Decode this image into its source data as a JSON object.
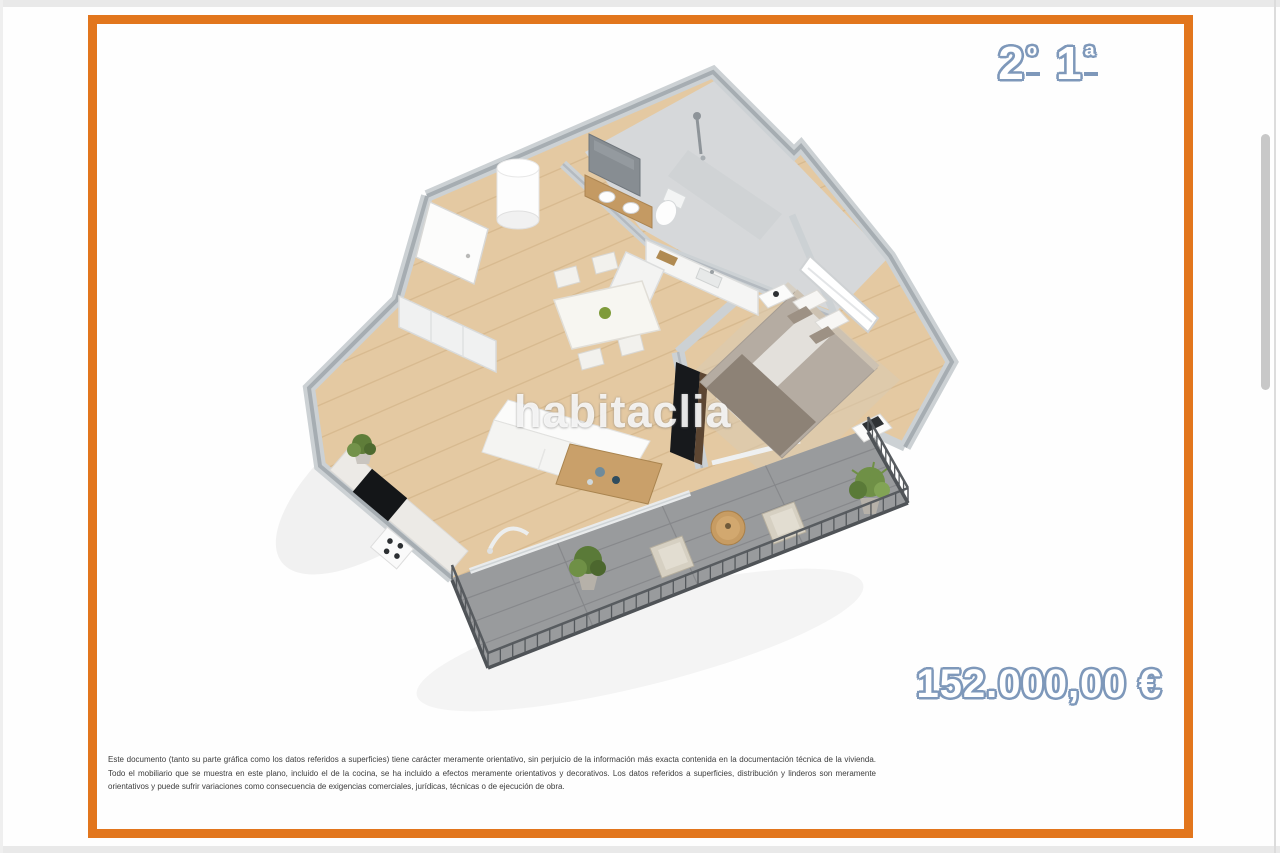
{
  "header": {
    "unit": {
      "floor_number": "2",
      "floor_ordinal": "º",
      "apartment_number": "1",
      "apartment_ordinal": "ª"
    }
  },
  "price_label": "152.000,00 €",
  "watermark_text": "habitaclia",
  "disclaimer": "Este documento (tanto su parte gráfica como los datos referidos a superficies) tiene carácter meramente orientativo, sin perjuicio de la información más exacta contenida en la documentación técnica de la vivienda. Todo el mobiliario que se muestra en este plano, incluido el de la cocina, se ha incluido a efectos meramente orientativos y decorativos. Los datos referidos a superficies, distribución y linderos son meramente orientativos y puede sufrir variaciones como consecuencia de exigencias comerciales, jurídicas, técnicas o de ejecución de obra.",
  "colors": {
    "frame_orange": "#e2761d",
    "label_outline_blue": "#7e98ba",
    "wall_gray": "#ccd1d4",
    "wall_top_gray": "#a6adb2",
    "wood_floor": "#e4c9a2",
    "wood_plank_line": "#d5b78c",
    "bathroom_floor": "#d6d8da",
    "terrace_tile": "#999b9d",
    "terrace_tile_line": "#85878a",
    "railing_dark_gray": "#4f5357",
    "watermark_white": "#ffffff"
  },
  "floor_plan": {
    "view": "isometric-3d-render",
    "elements": [
      "entrance-hall",
      "entry-door",
      "wardrobe",
      "water-heater",
      "bathroom",
      "wall-mirror",
      "vanity-sink",
      "toilet",
      "shower",
      "kitchen-counter",
      "kitchen-sink",
      "cooktop",
      "oven-knobs",
      "dining-table",
      "dining-chairs",
      "green-centerpiece",
      "living-room",
      "sofa",
      "coffee-table",
      "floor-lamp",
      "tv-panel",
      "bedroom",
      "double-bed",
      "pillows",
      "headboard",
      "nightstand-left",
      "nightstand-right",
      "bedroom-window",
      "bedroom-rug",
      "sliding-door",
      "terrace",
      "terrace-tiles",
      "railing",
      "outdoor-armchair-left",
      "outdoor-armchair-right",
      "outdoor-round-table",
      "plant-terrace-left",
      "plant-terrace-right",
      "plant-kitchen"
    ]
  }
}
